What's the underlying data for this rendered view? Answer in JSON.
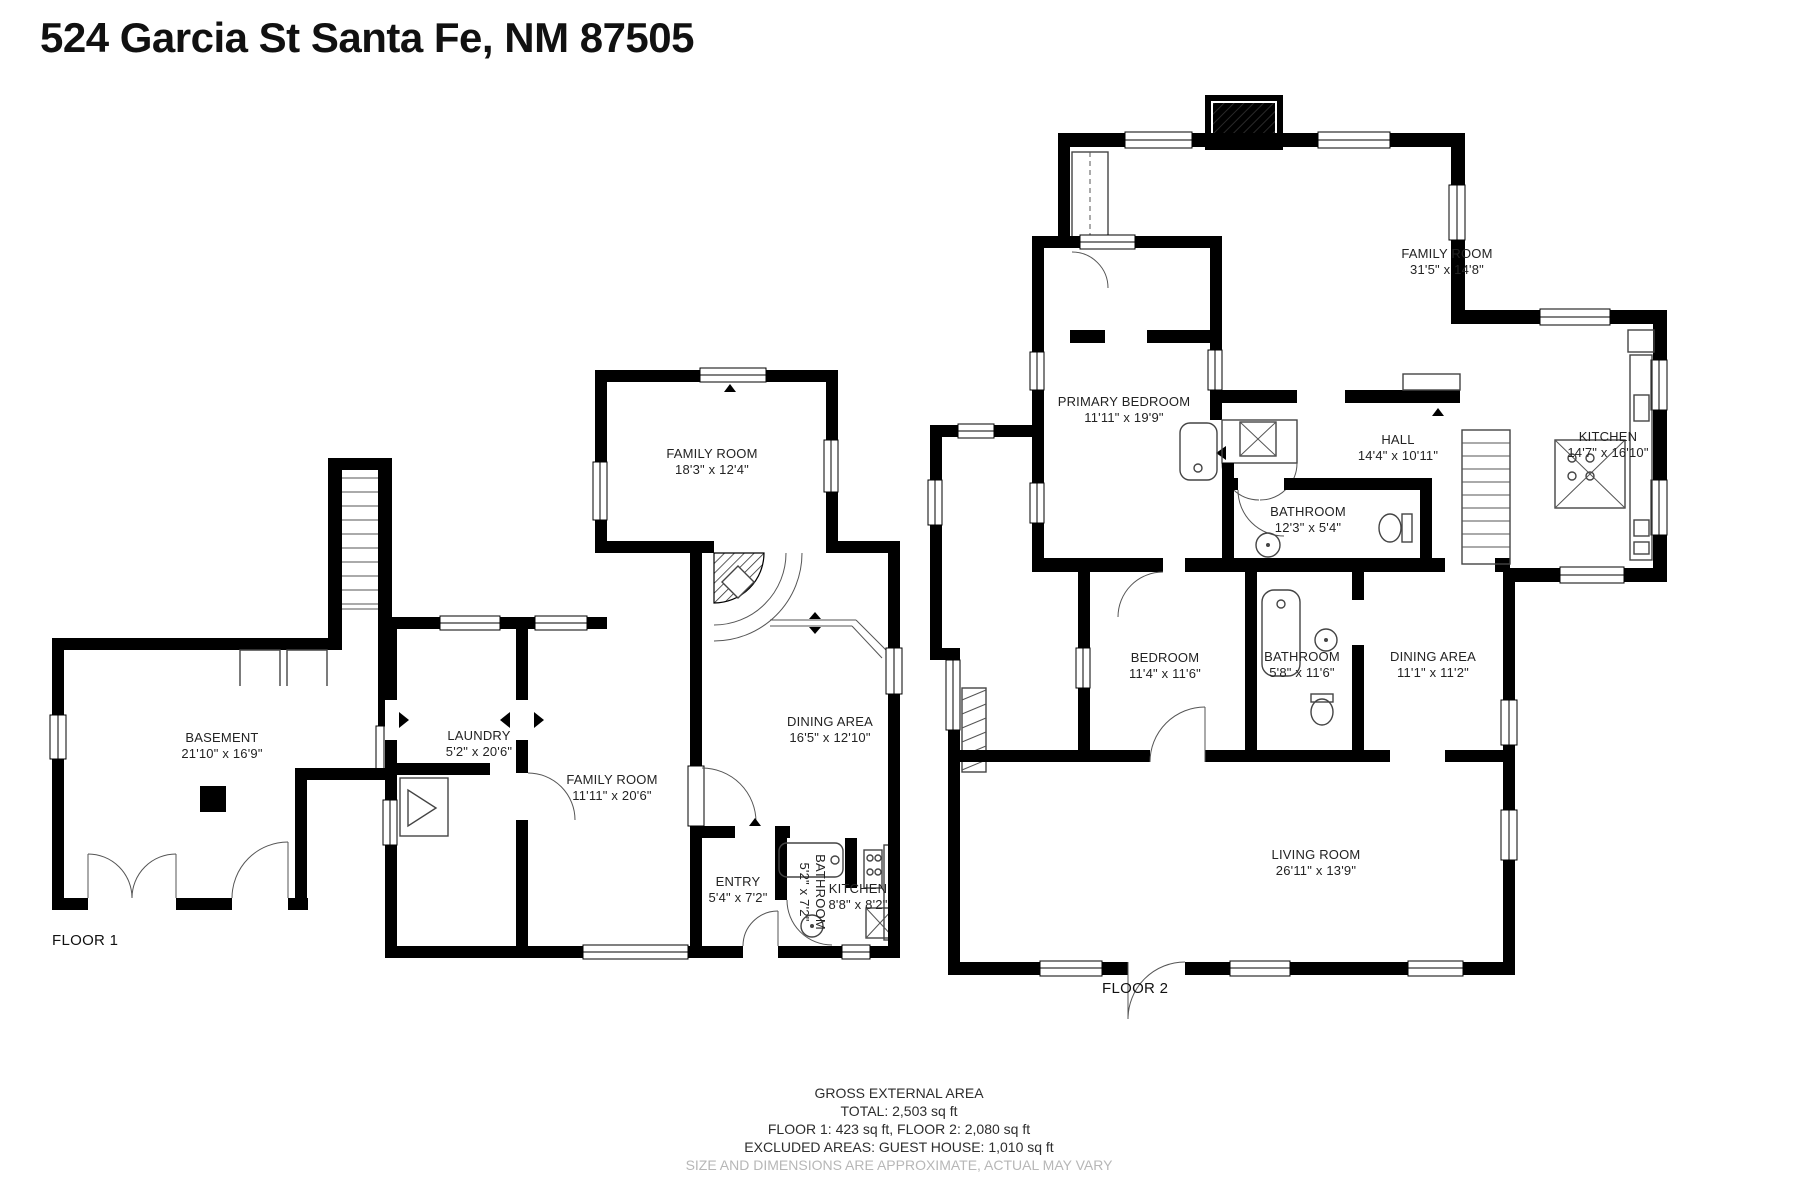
{
  "title": "524 Garcia St Santa Fe, NM 87505",
  "plans": {
    "floor1": {
      "label": "FLOOR 1",
      "rooms": {
        "basement": {
          "name": "BASEMENT",
          "dims": "21'10\" x 16'9\""
        }
      }
    },
    "guest_house": {
      "rooms": {
        "family_room_upper": {
          "name": "FAMILY ROOM",
          "dims": "18'3\" x 12'4\""
        },
        "laundry": {
          "name": "LAUNDRY",
          "dims": "5'2\" x 20'6\""
        },
        "family_room": {
          "name": "FAMILY ROOM",
          "dims": "11'11\" x 20'6\""
        },
        "dining_area": {
          "name": "DINING AREA",
          "dims": "16'5\" x 12'10\""
        },
        "entry": {
          "name": "ENTRY",
          "dims": "5'4\" x 7'2\""
        },
        "bathroom": {
          "name": "BATHROOM",
          "dims": "5'2\" x 7'2\""
        },
        "kitchen": {
          "name": "KITCHEN",
          "dims": "8'8\" x 8'2\""
        }
      }
    },
    "floor2": {
      "label": "FLOOR 2",
      "rooms": {
        "primary_bedroom": {
          "name": "PRIMARY BEDROOM",
          "dims": "11'11\" x 19'9\""
        },
        "family_room": {
          "name": "FAMILY ROOM",
          "dims": "31'5\" x 14'8\""
        },
        "hall": {
          "name": "HALL",
          "dims": "14'4\" x 10'11\""
        },
        "kitchen": {
          "name": "KITCHEN",
          "dims": "14'7\" x 16'10\""
        },
        "bathroom_hall": {
          "name": "BATHROOM",
          "dims": "12'3\" x 5'4\""
        },
        "bedroom": {
          "name": "BEDROOM",
          "dims": "11'4\" x 11'6\""
        },
        "bathroom": {
          "name": "BATHROOM",
          "dims": "5'8\" x 11'6\""
        },
        "dining_area": {
          "name": "DINING AREA",
          "dims": "11'1\" x 11'2\""
        },
        "living_room": {
          "name": "LIVING ROOM",
          "dims": "26'11\" x 13'9\""
        }
      }
    }
  },
  "footer": {
    "heading": "GROSS EXTERNAL AREA",
    "total": "TOTAL: 2,503 sq ft",
    "floors": "FLOOR 1: 423 sq ft, FLOOR 2: 2,080 sq ft",
    "excluded": "EXCLUDED AREAS: GUEST HOUSE: 1,010 sq ft",
    "disclaimer": "SIZE AND DIMENSIONS ARE APPROXIMATE, ACTUAL MAY VARY"
  }
}
